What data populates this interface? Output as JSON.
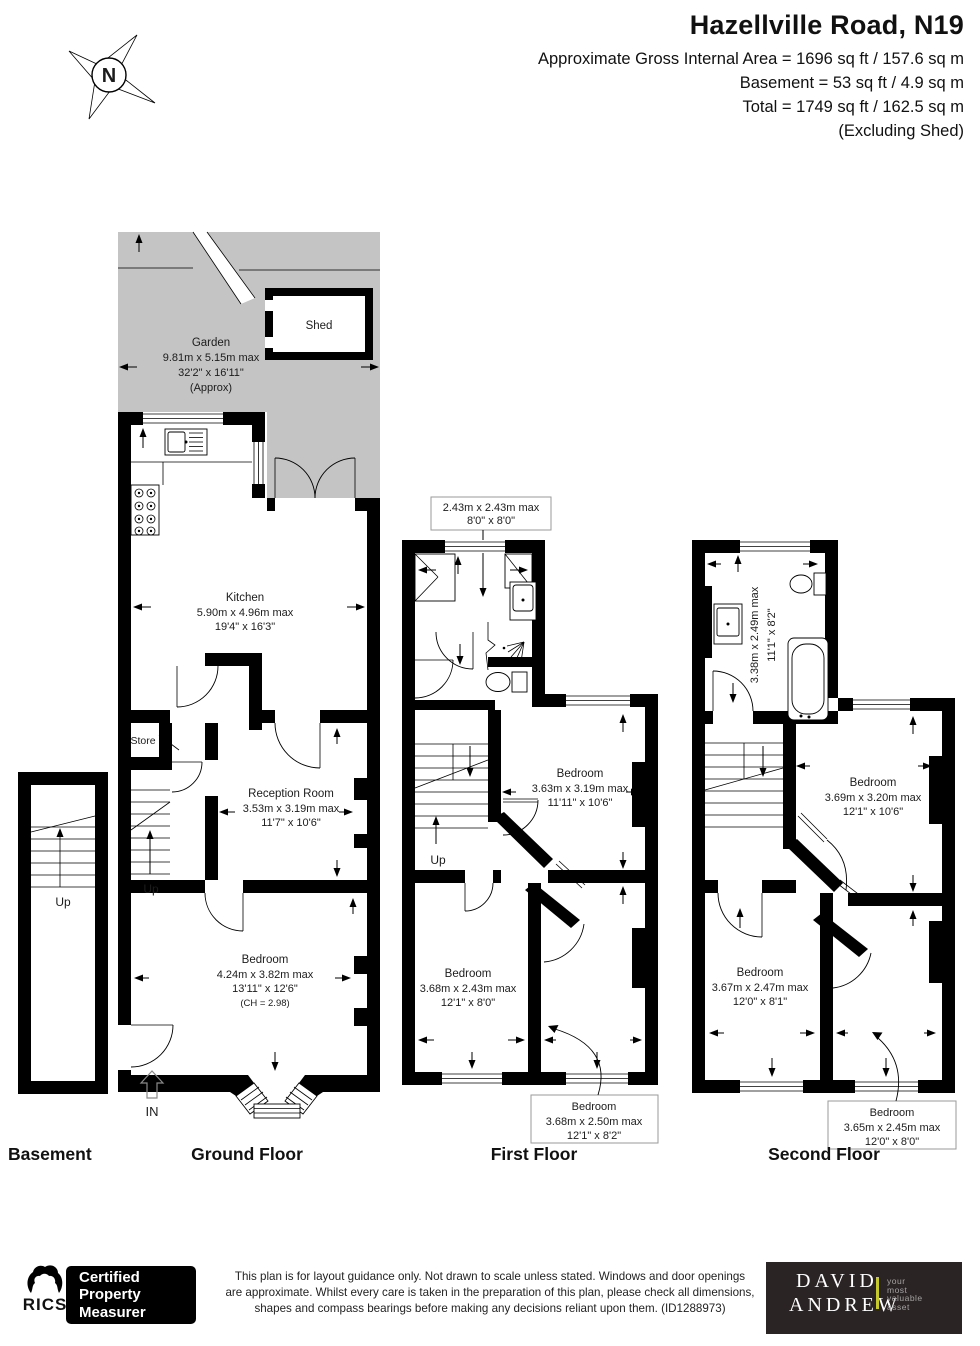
{
  "header": {
    "title": "Hazellville Road, N19",
    "area_line1": "Approximate Gross Internal Area = 1696 sq ft / 157.6 sq m",
    "area_line2": "Basement = 53 sq ft / 4.9 sq m",
    "area_line3": "Total = 1749 sq ft / 162.5 sq m",
    "area_line4": "(Excluding Shed)",
    "compass_n": "N"
  },
  "basement": {
    "floor_label": "Basement",
    "up": "Up"
  },
  "ground": {
    "floor_label": "Ground Floor",
    "garden_name": "Garden",
    "garden_dims_m": "9.81m x 5.15m max",
    "garden_dims_ft": "32'2\" x 16'11\"",
    "garden_note": "(Approx)",
    "shed_name": "Shed",
    "kitchen_name": "Kitchen",
    "kitchen_dims_m": "5.90m x 4.96m max",
    "kitchen_dims_ft": "19'4\" x 16'3\"",
    "store_name": "Store",
    "reception_name": "Reception Room",
    "reception_dims_m": "3.53m x 3.19m max",
    "reception_dims_ft": "11'7\" x 10'6\"",
    "bedroom_name": "Bedroom",
    "bedroom_dims_m": "4.24m x 3.82m max",
    "bedroom_dims_ft": "13'11\" x 12'6\"",
    "bedroom_note": "(CH = 2.98)",
    "up": "Up",
    "in": "IN"
  },
  "first": {
    "floor_label": "First Floor",
    "callout_top_dims_m": "2.43m x 2.43m max",
    "callout_top_dims_ft": "8'0\" x 8'0\"",
    "bedroom1_name": "Bedroom",
    "bedroom1_dims_m": "3.63m x 3.19m max",
    "bedroom1_dims_ft": "11'11\" x 10'6\"",
    "bedroom2_name": "Bedroom",
    "bedroom2_dims_m": "3.68m x 2.43m max",
    "bedroom2_dims_ft": "12'1\" x 8'0\"",
    "callout_bottom_name": "Bedroom",
    "callout_bottom_dims_m": "3.68m x 2.50m max",
    "callout_bottom_dims_ft": "12'1\" x 8'2\"",
    "up": "Up"
  },
  "second": {
    "floor_label": "Second Floor",
    "bath_dims_m": "3.38m x 2.49m max",
    "bath_dims_ft": "11'1\" x 8'2\"",
    "bedroom1_name": "Bedroom",
    "bedroom1_dims_m": "3.69m x 3.20m max",
    "bedroom1_dims_ft": "12'1\" x 10'6\"",
    "bedroom2_name": "Bedroom",
    "bedroom2_dims_m": "3.67m x 2.47m max",
    "bedroom2_dims_ft": "12'0\" x 8'1\"",
    "callout_bottom_name": "Bedroom",
    "callout_bottom_dims_m": "3.65m x 2.45m max",
    "callout_bottom_dims_ft": "12'0\" x 8'0\""
  },
  "footer": {
    "rics": "RICS",
    "cpm_line1": "Certified",
    "cpm_line2": "Property",
    "cpm_line3": "Measurer",
    "disclaimer_line1": "This plan is for layout guidance only. Not drawn to scale unless stated. Windows and door openings",
    "disclaimer_line2": "are approximate. Whilst every care is taken in the preparation of this plan, please check all dimensions,",
    "disclaimer_line3": "shapes and compass bearings before making any decisions reliant upon them. (ID1288973)",
    "agent_line1": "DAVID",
    "agent_line2": "ANDREW",
    "agent_tag1": "your",
    "agent_tag2": "most",
    "agent_tag3": "valuable",
    "agent_tag4": "asset"
  },
  "colors": {
    "garden": "#c4c4c4",
    "wall": "#000000",
    "agent_bg": "#2a2425",
    "agent_accent": "#c5c92e",
    "callout_border": "#9a9a9a"
  }
}
